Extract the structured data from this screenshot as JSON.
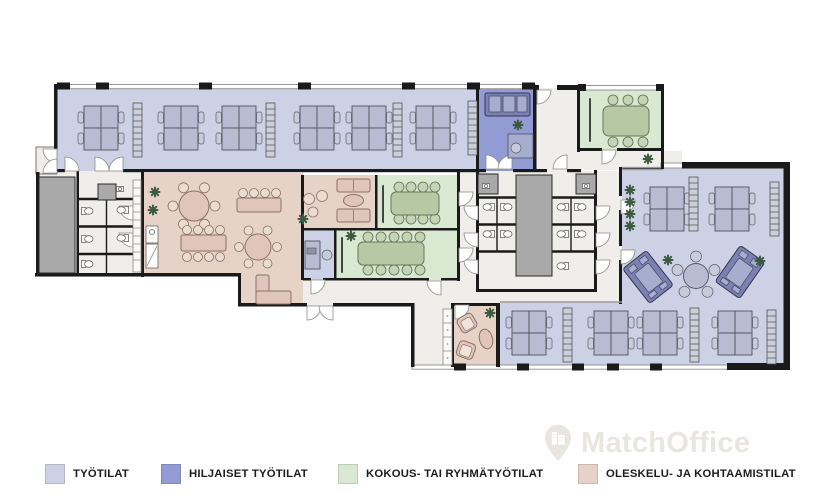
{
  "legend": {
    "items": [
      {
        "id": "work",
        "label": "TYÖTILAT",
        "color": "#cdd1e5"
      },
      {
        "id": "quiet",
        "label": "HILJAISET TYÖTILAT",
        "color": "#939bd4"
      },
      {
        "id": "meeting",
        "label": "KOKOUS- TAI RYHMÄTYÖTILAT",
        "color": "#d9e8d0"
      },
      {
        "id": "lounge",
        "label": "OLESKELU- JA KOHTAAMISTILAT",
        "color": "#e7d2c8"
      }
    ]
  },
  "watermark": {
    "brand": "MatchOffice"
  },
  "palette": {
    "wall": "#1a1a1a",
    "floor": "#efeeea",
    "service": "#a9a9a9",
    "desk": "#b7bcd2",
    "meeting_table": "#b6c8a4",
    "lounge_furniture": "#dfc5bb",
    "quiet_furniture": "#7b82b3",
    "plant": "#3c5a40",
    "watermark": "#e9e6e1"
  }
}
